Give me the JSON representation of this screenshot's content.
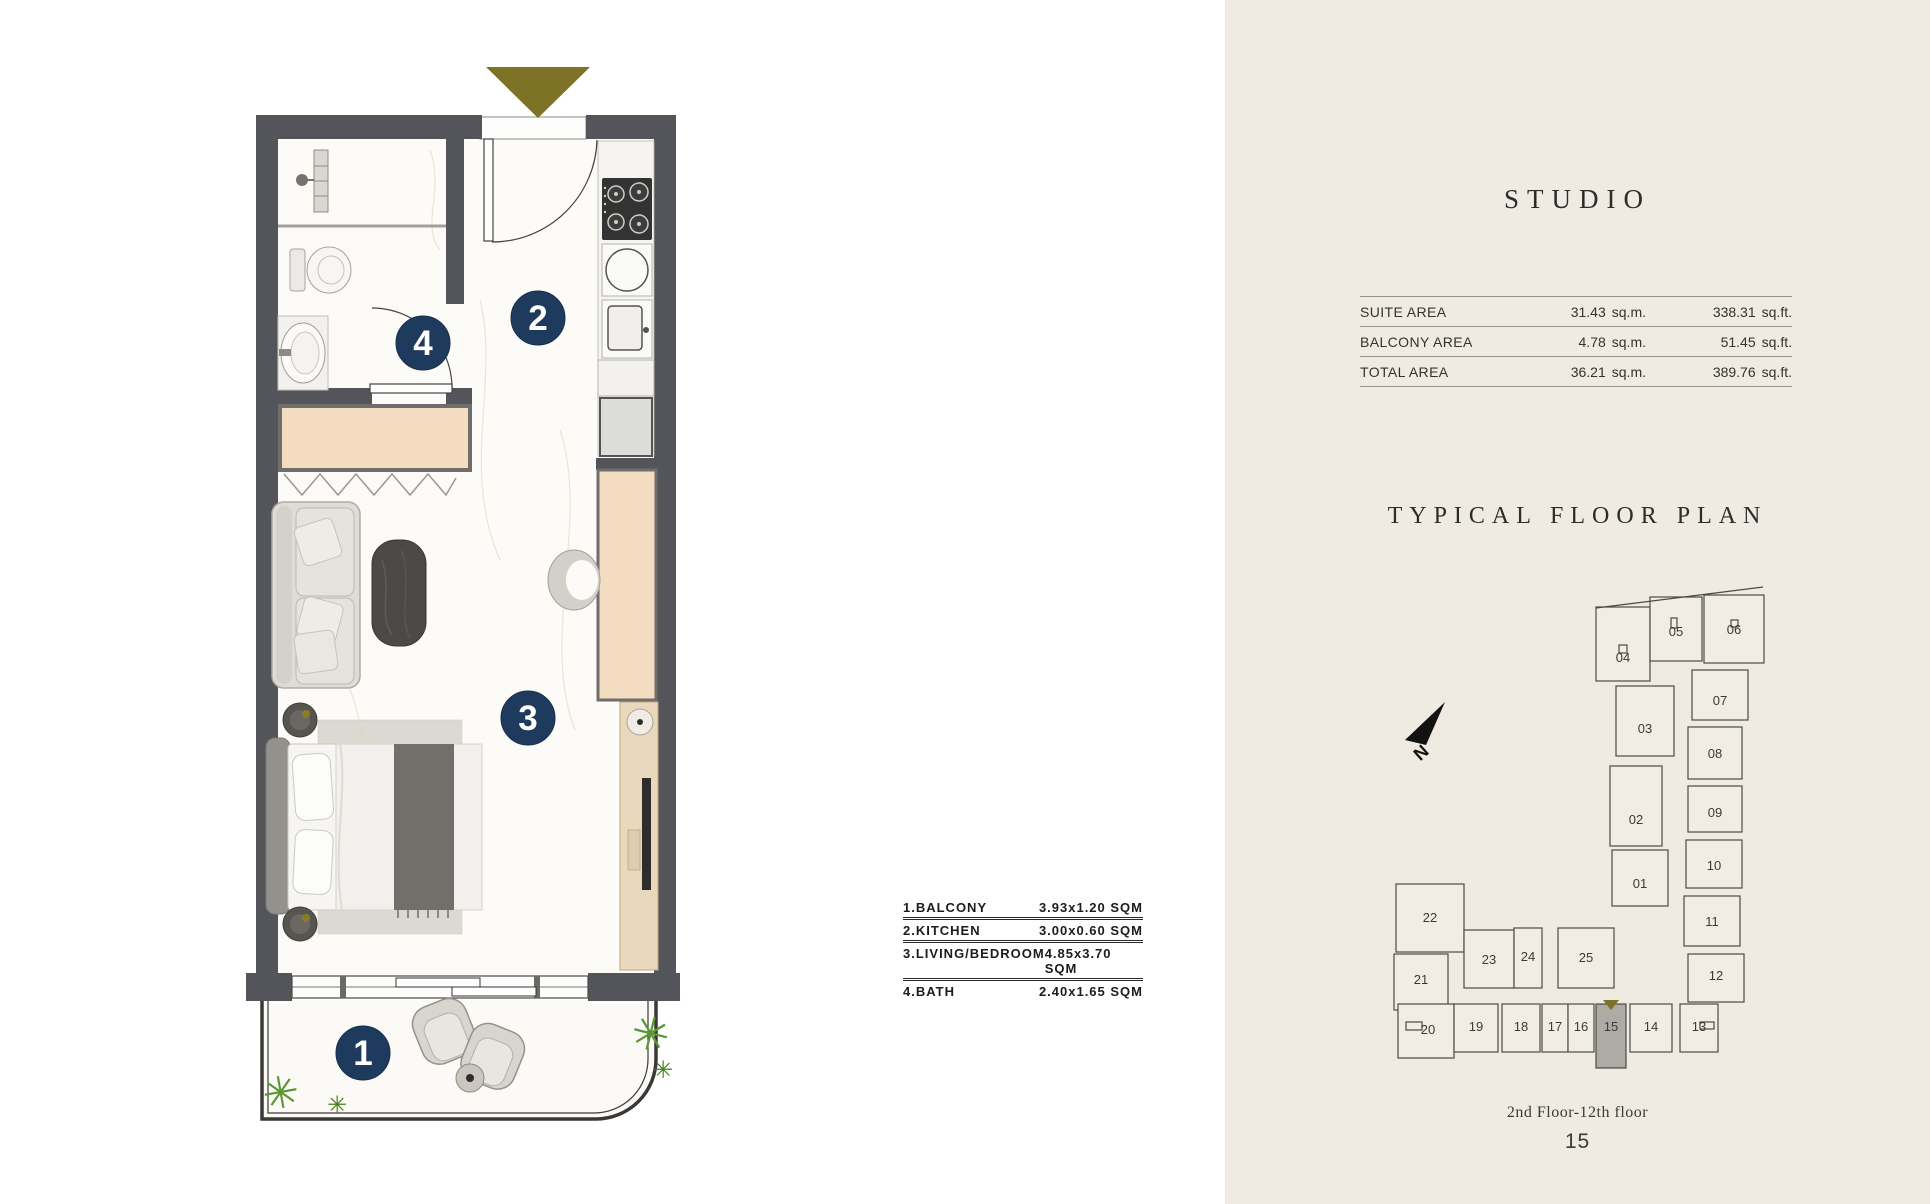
{
  "left": {
    "markers": [
      {
        "id": "balcony",
        "label": "1"
      },
      {
        "id": "kitchen",
        "label": "2"
      },
      {
        "id": "living-bedroom",
        "label": "3"
      },
      {
        "id": "bath",
        "label": "4"
      }
    ],
    "legend": {
      "rows": [
        {
          "label": "1.BALCONY",
          "size": "3.93x1.20 SQM"
        },
        {
          "label": "2.KITCHEN",
          "size": "3.00x0.60 SQM"
        },
        {
          "label": "3.LIVING/BEDROOM",
          "size": "4.85x3.70 SQM"
        },
        {
          "label": "4.BATH",
          "size": "2.40x1.65 SQM"
        }
      ]
    }
  },
  "right": {
    "title": "STUDIO",
    "area_table": {
      "rows": [
        {
          "label": "SUITE AREA",
          "sqm_value": "31.43",
          "sqm_unit": "sq.m.",
          "sqft_value": "338.31",
          "sqft_unit": "sq.ft."
        },
        {
          "label": "BALCONY AREA",
          "sqm_value": "4.78",
          "sqm_unit": "sq.m.",
          "sqft_value": "51.45",
          "sqft_unit": "sq.ft."
        },
        {
          "label": "TOTAL AREA",
          "sqm_value": "36.21",
          "sqm_unit": "sq.m.",
          "sqft_value": "389.76",
          "sqft_unit": "sq.ft."
        }
      ]
    },
    "plan_heading": "TYPICAL FLOOR PLAN",
    "compass": "N",
    "floor_range": "2nd Floor-12th floor",
    "highlighted_unit": "15",
    "units": [
      {
        "label": "01"
      },
      {
        "label": "02"
      },
      {
        "label": "03"
      },
      {
        "label": "04"
      },
      {
        "label": "05"
      },
      {
        "label": "06"
      },
      {
        "label": "07"
      },
      {
        "label": "08"
      },
      {
        "label": "09"
      },
      {
        "label": "10"
      },
      {
        "label": "11"
      },
      {
        "label": "12"
      },
      {
        "label": "13"
      },
      {
        "label": "14"
      },
      {
        "label": "15",
        "highlighted": true
      },
      {
        "label": "16"
      },
      {
        "label": "17"
      },
      {
        "label": "18"
      },
      {
        "label": "19"
      },
      {
        "label": "20"
      },
      {
        "label": "21"
      },
      {
        "label": "22"
      },
      {
        "label": "23"
      },
      {
        "label": "24"
      },
      {
        "label": "25"
      }
    ]
  },
  "icons": {
    "plant_glyph": "✳",
    "entrance_marker": "triangle-down"
  },
  "colors": {
    "panel_bg": "#efebe2",
    "wall_gray": "#54555a",
    "accent_navy": "#1e3a5c",
    "accent_olive": "#7d7226",
    "furniture_tan": "#f4dcc0",
    "highlight_unit_fill": "#aeaba5",
    "plant_green": "#5c9733"
  }
}
